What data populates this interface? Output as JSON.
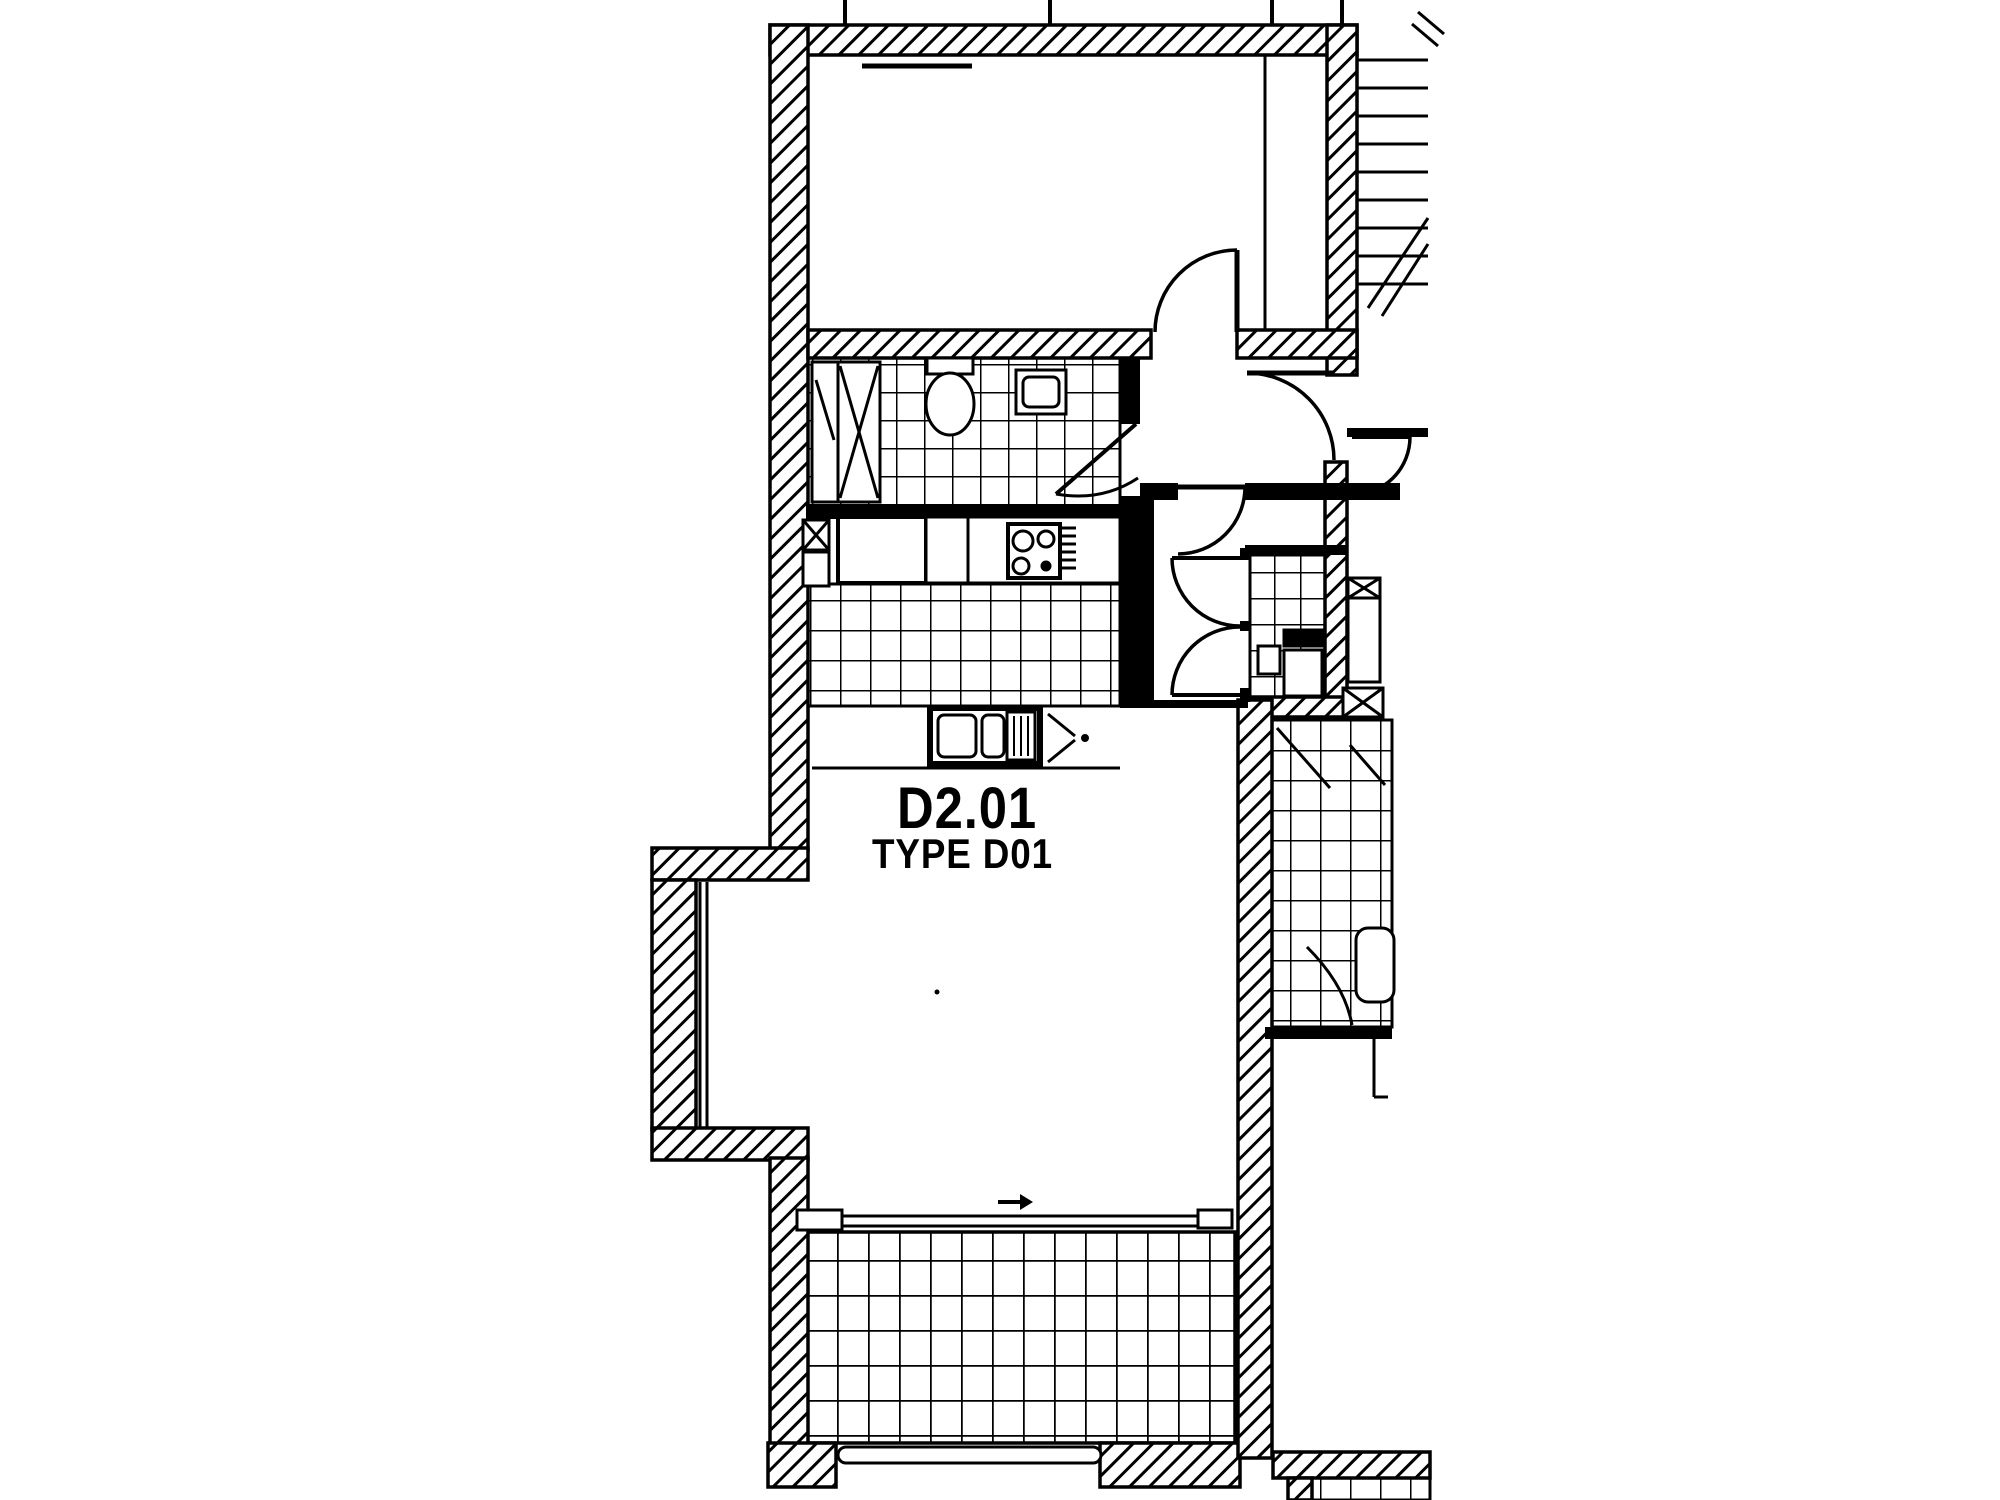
{
  "page": {
    "paper_color": "#ffffff",
    "ink_color": "#000000",
    "kind": "architectural floor plan (scanned, monochrome)"
  },
  "plan": {
    "unit_label": "D2.01",
    "unit_type_label": "TYPE D01"
  }
}
